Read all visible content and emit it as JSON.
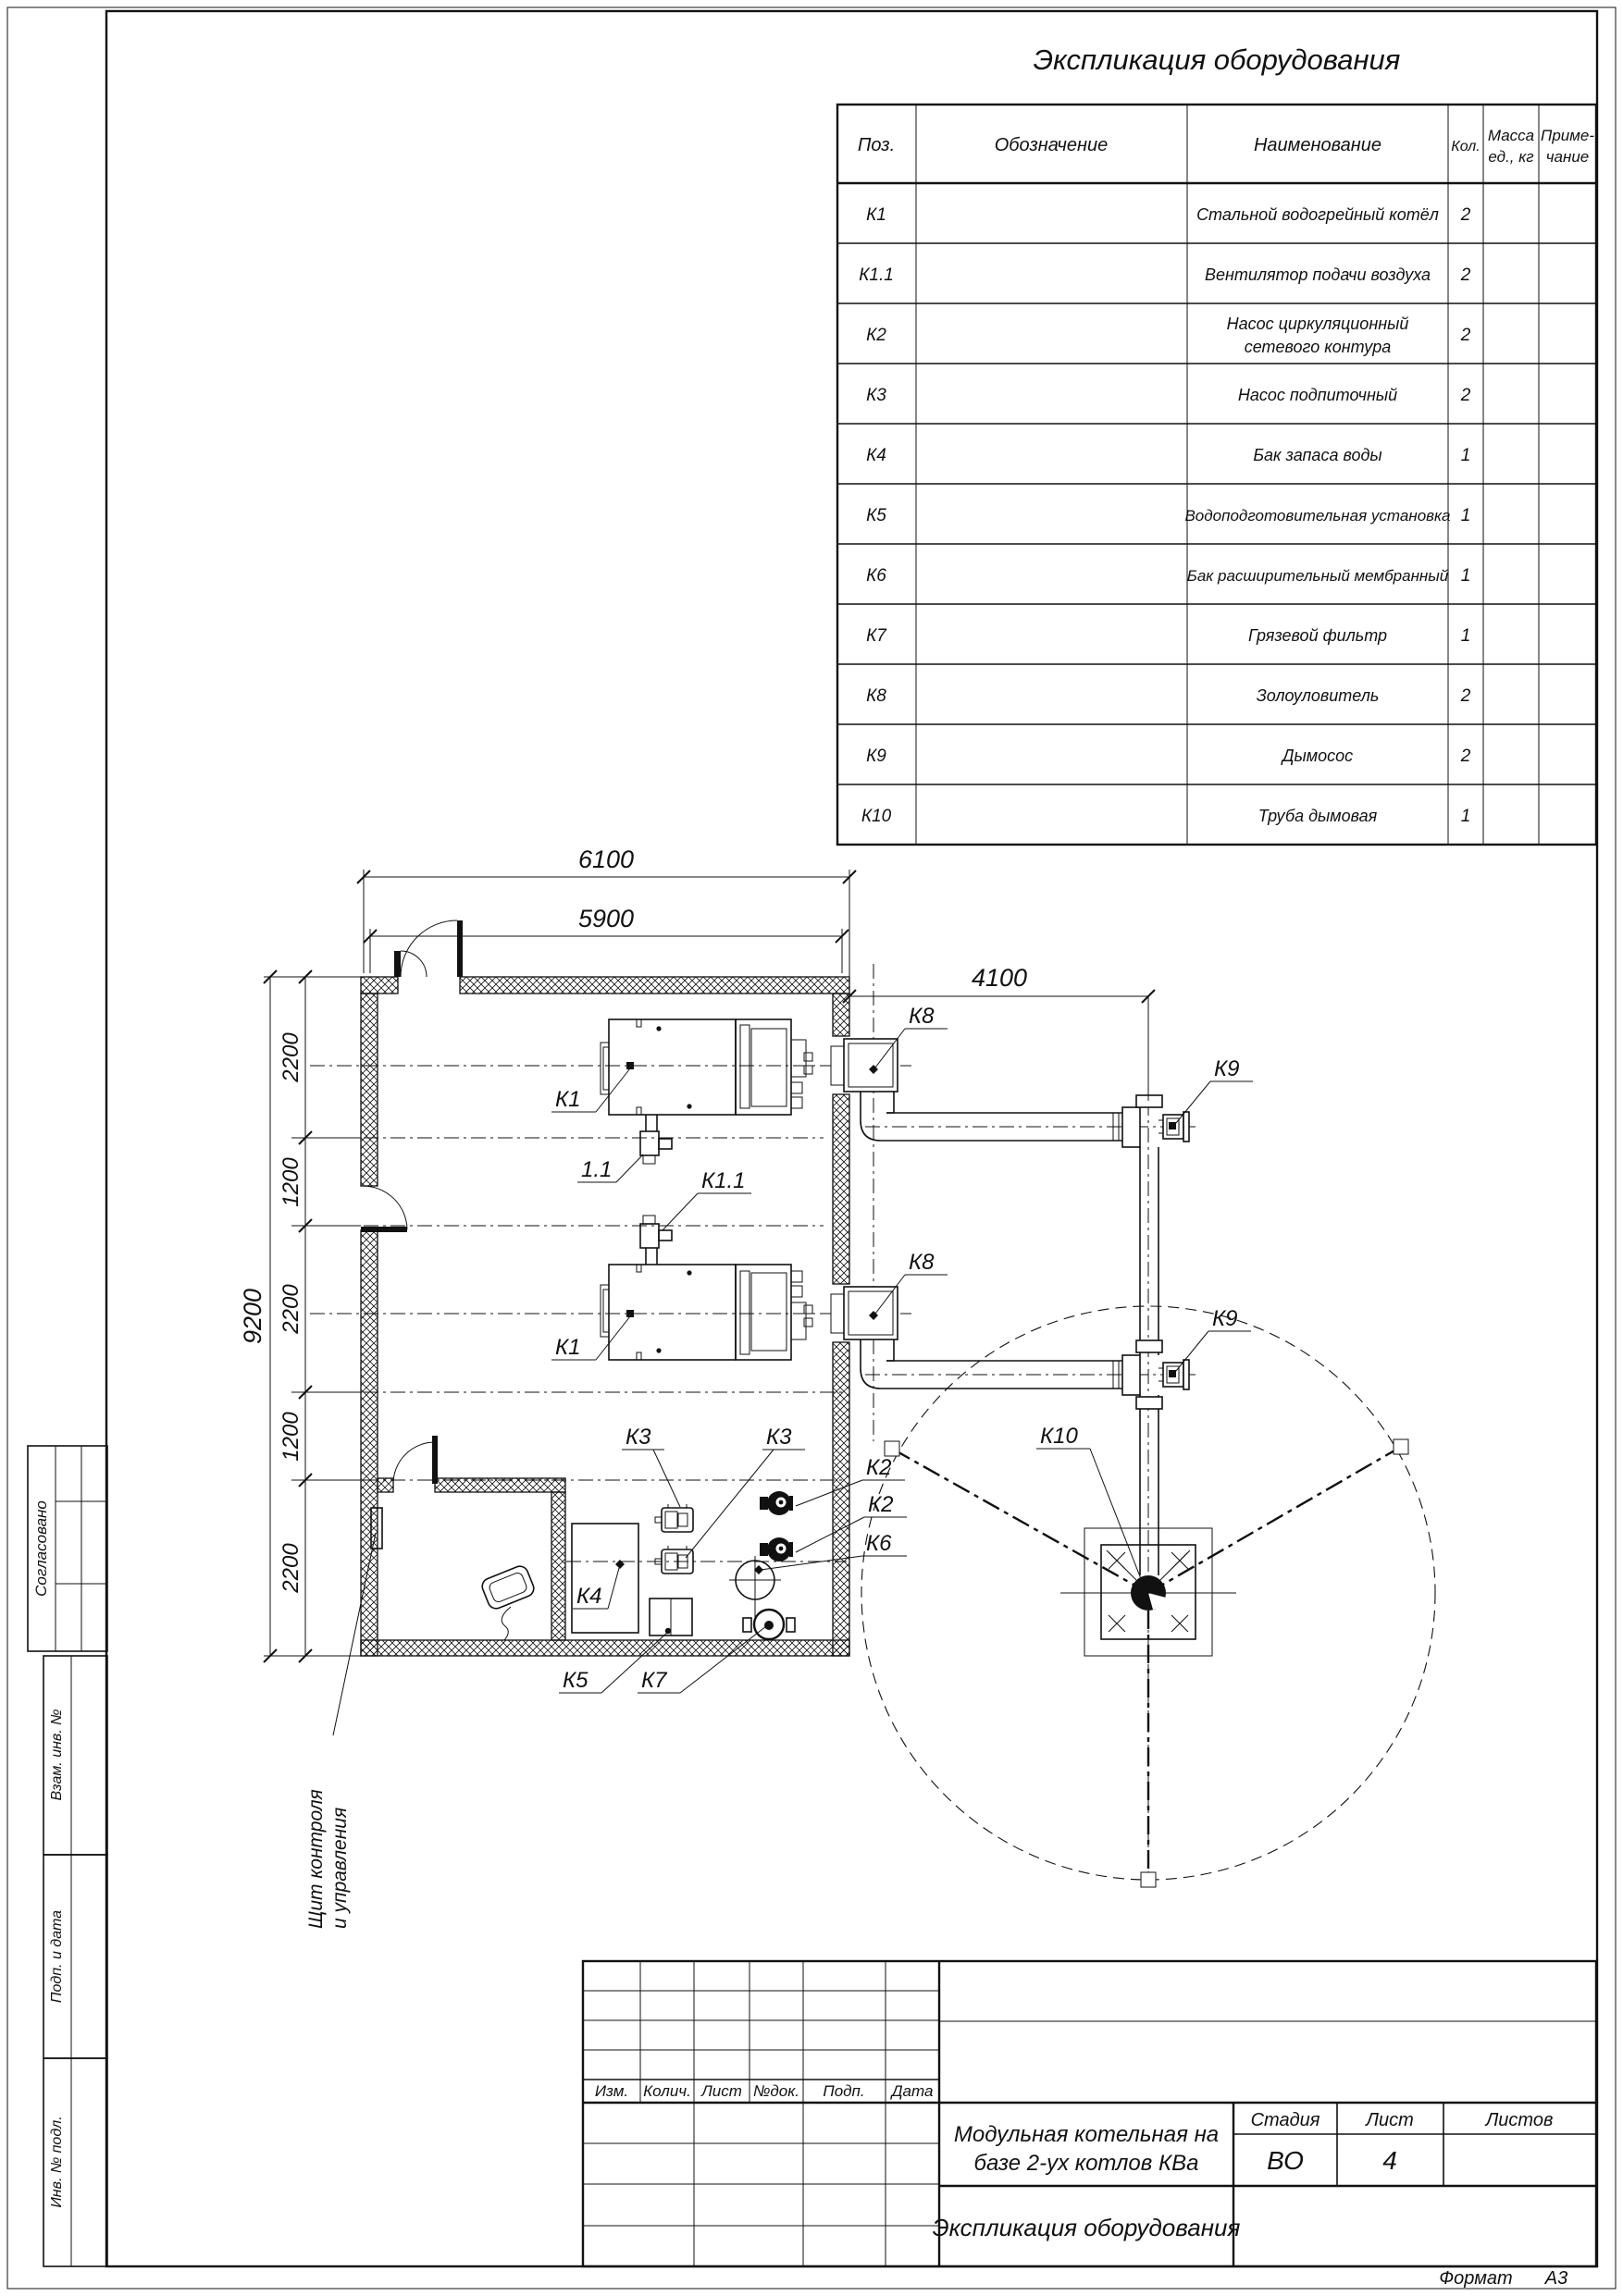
{
  "sheet": {
    "format_label": "Формат",
    "format_value": "А3"
  },
  "eq": {
    "title": "Экспликация оборудования",
    "col_pos": "Поз.",
    "col_designation": "Обозначение",
    "col_name": "Наименование",
    "col_qty": "Кол.",
    "col_mass1": "Масса",
    "col_mass2": "ед., кг",
    "col_note1": "Приме-",
    "col_note2": "чание",
    "rows": [
      {
        "pos": "К1",
        "designation": "",
        "name": "Стальной водогрейный котёл",
        "name2": "",
        "qty": "2",
        "mass": "",
        "note": ""
      },
      {
        "pos": "К1.1",
        "designation": "",
        "name": "Вентилятор подачи воздуха",
        "name2": "",
        "qty": "2",
        "mass": "",
        "note": ""
      },
      {
        "pos": "К2",
        "designation": "",
        "name": "Насос циркуляционный",
        "name2": "сетевого контура",
        "qty": "2",
        "mass": "",
        "note": ""
      },
      {
        "pos": "К3",
        "designation": "",
        "name": "Насос подпиточный",
        "name2": "",
        "qty": "2",
        "mass": "",
        "note": ""
      },
      {
        "pos": "К4",
        "designation": "",
        "name": "Бак запаса воды",
        "name2": "",
        "qty": "1",
        "mass": "",
        "note": ""
      },
      {
        "pos": "К5",
        "designation": "",
        "name": "Водоподготовительная установка",
        "name2": "",
        "qty": "1",
        "mass": "",
        "note": ""
      },
      {
        "pos": "К6",
        "designation": "",
        "name": "Бак расширительный мембранный",
        "name2": "",
        "qty": "1",
        "mass": "",
        "note": ""
      },
      {
        "pos": "К7",
        "designation": "",
        "name": "Грязевой фильтр",
        "name2": "",
        "qty": "1",
        "mass": "",
        "note": ""
      },
      {
        "pos": "К8",
        "designation": "",
        "name": "Золоуловитель",
        "name2": "",
        "qty": "2",
        "mass": "",
        "note": ""
      },
      {
        "pos": "К9",
        "designation": "",
        "name": "Дымосос",
        "name2": "",
        "qty": "2",
        "mass": "",
        "note": ""
      },
      {
        "pos": "К10",
        "designation": "",
        "name": "Труба дымовая",
        "name2": "",
        "qty": "1",
        "mass": "",
        "note": ""
      }
    ]
  },
  "tb": {
    "rev_izm": "Изм.",
    "rev_kol": "Колич.",
    "rev_list": "Лист",
    "rev_ndok": "№док.",
    "rev_podp": "Подп.",
    "rev_data": "Дата",
    "project1": "Модульная котельная на",
    "project2": "базе 2-ух котлов КВа",
    "stage_label": "Стадия",
    "list_label": "Лист",
    "listov_label": "Листов",
    "stage": "ВО",
    "list": "4",
    "listov": "",
    "doc_title": "Экспликация оборудования"
  },
  "stamps": {
    "agreed": "Согласовано",
    "zam": "Взам. инв. №",
    "podp": "Подп. и дата",
    "inv": "Инв. № подл."
  },
  "plan": {
    "d6100": "6100",
    "d5900": "5900",
    "d4100": "4100",
    "d9200": "9200",
    "c1": "2200",
    "c2": "1200",
    "c3": "2200",
    "c4": "1200",
    "c5": "2200",
    "k1": "К1",
    "k11_fan": "1.1",
    "k11": "К1.1",
    "k2": "К2",
    "k3": "К3",
    "k4": "К4",
    "k5": "К5",
    "k6": "К6",
    "k7": "К7",
    "k8": "К8",
    "k9": "К9",
    "k10": "К10",
    "panel1": "Щит контроля",
    "panel2": "и управления"
  }
}
